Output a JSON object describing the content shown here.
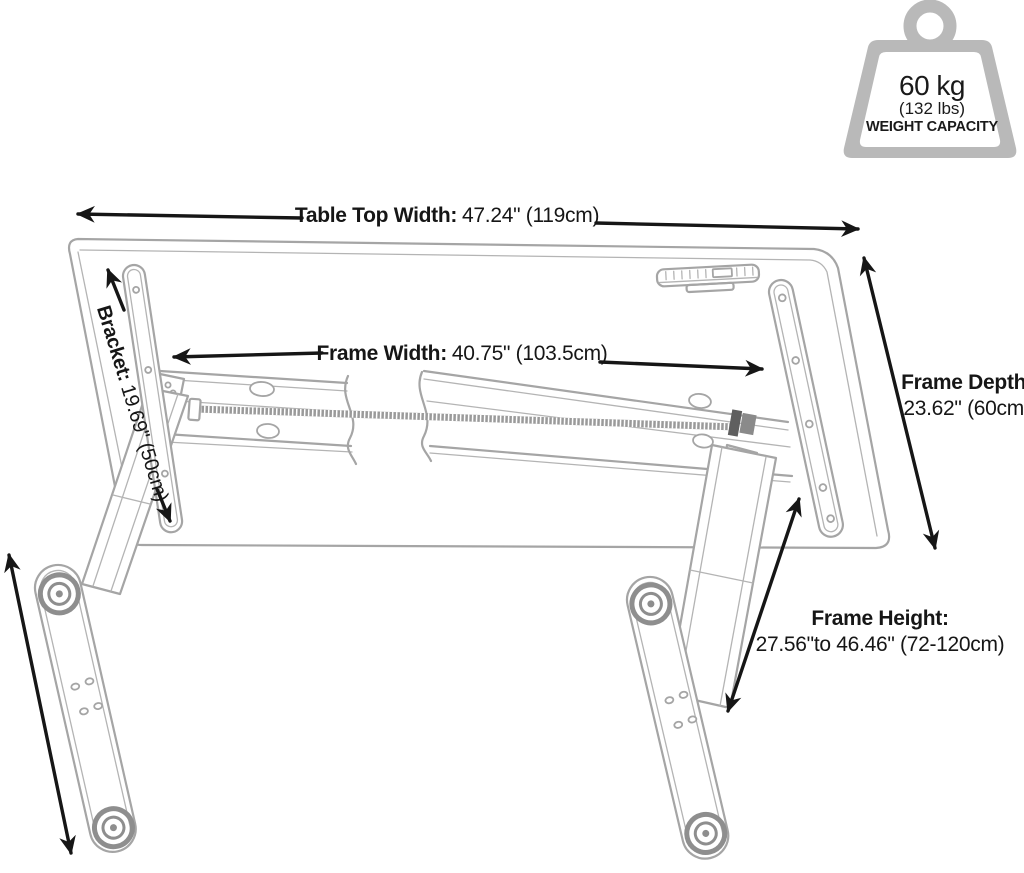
{
  "diagram": {
    "weight_capacity": {
      "value": "60 kg",
      "alt_value": "(132 lbs)",
      "label": "WEIGHT CAPACITY"
    },
    "dimensions": {
      "table_top_width": {
        "label": "Table Top Width:",
        "value": "47.24\" (119cm)"
      },
      "frame_width": {
        "label": "Frame Width:",
        "value": "40.75\" (103.5cm)"
      },
      "frame_depth": {
        "label": "Frame Depth:",
        "value": "23.62\" (60cm)"
      },
      "frame_height": {
        "label": "Frame Height:",
        "value": "27.56\"to 46.46\" (72-120cm)"
      },
      "bracket": {
        "label": "Bracket:",
        "value": "19.69\" (50cm)"
      }
    },
    "colors": {
      "line_art": "#a5a5a5",
      "line_art_light": "#b4b4b4",
      "dimension_ink": "#161616",
      "weight_icon_gray": "#b9b9b9",
      "leveler_gray": "#8e8e8e"
    }
  }
}
